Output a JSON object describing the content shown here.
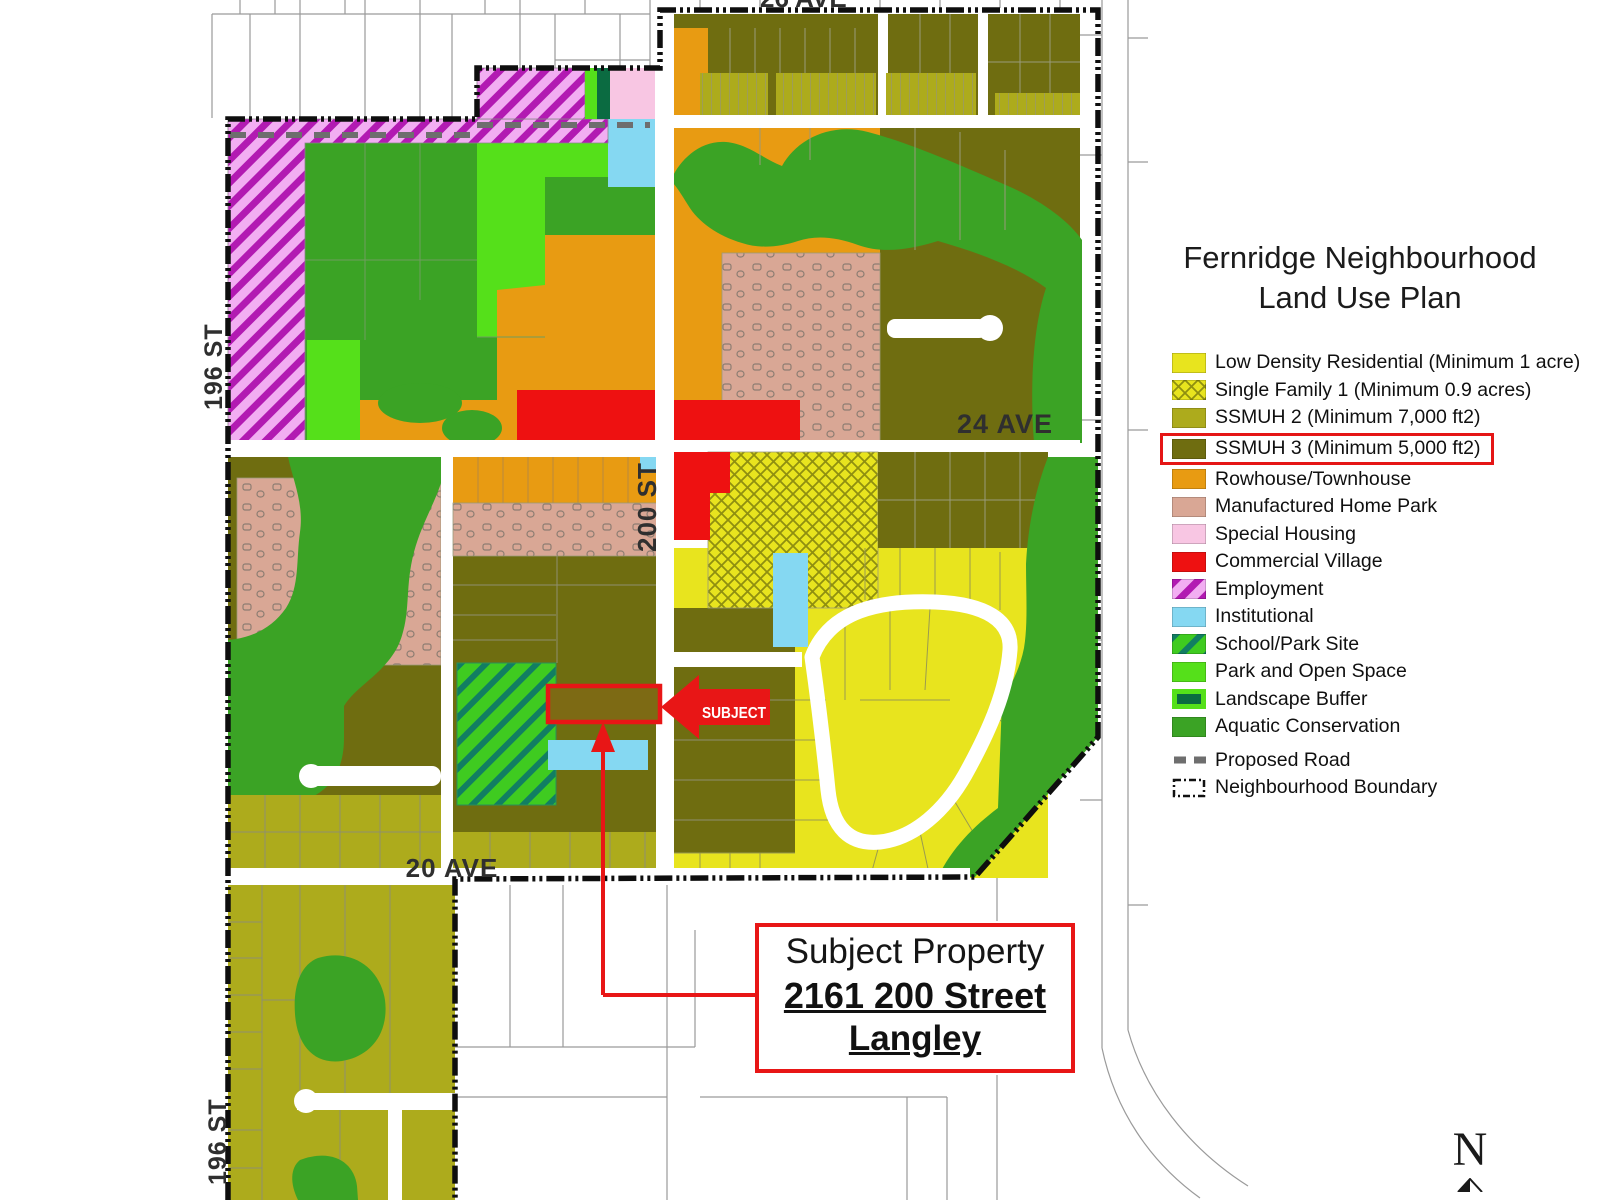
{
  "title": {
    "line1": "Fernridge Neighbourhood",
    "line2": "Land Use Plan"
  },
  "map": {
    "street_labels": {
      "ave26_clipped": "26 AVE",
      "ave24": "24 AVE",
      "ave20": "20 AVE",
      "st200": "200 ST",
      "st196_upper": "196 ST",
      "st196_lower": "196 ST"
    },
    "subject_label": "SUBJECT"
  },
  "callout": {
    "line1": "Subject Property",
    "line2": "2161 200 Street",
    "line3": "Langley"
  },
  "compass": {
    "label": "N"
  },
  "legend": {
    "items": [
      {
        "label": "Low Density Residential (Minimum 1 acre)",
        "color": "#e8e41e",
        "swatch": "solid"
      },
      {
        "label": "Single Family 1 (Minimum 0.9 acres)",
        "color": "#e8e41e",
        "stripe": "#8f8f10",
        "swatch": "crosshatch"
      },
      {
        "label": "SSMUH 2 (Minimum 7,000 ft2)",
        "color": "#adab1c",
        "swatch": "solid"
      },
      {
        "label": "SSMUH 3 (Minimum 5,000 ft2)",
        "color": "#6f6d10",
        "swatch": "solid",
        "highlighted": true
      },
      {
        "label": "Rowhouse/Townhouse",
        "color": "#e89b12",
        "swatch": "solid"
      },
      {
        "label": "Manufactured Home Park",
        "color": "#d9a795",
        "swatch": "solid"
      },
      {
        "label": "Special Housing",
        "color": "#f8c6e3",
        "swatch": "solid"
      },
      {
        "label": "Commercial Village",
        "color": "#ee1111",
        "swatch": "solid"
      },
      {
        "label": "Employment",
        "color": "#f2aef2",
        "stripe": "#b21ab2",
        "swatch": "stripes"
      },
      {
        "label": "Institutional",
        "color": "#85d8f2",
        "swatch": "solid"
      },
      {
        "label": "School/Park Site",
        "color": "#3fcb20",
        "stripe": "#117e62",
        "swatch": "stripes"
      },
      {
        "label": "Park and Open Space",
        "color": "#55e01a",
        "swatch": "solid"
      },
      {
        "label": "Landscape Buffer",
        "color": "#0b6b41",
        "border": "#55e01a",
        "swatch": "bordered"
      },
      {
        "label": "Aquatic Conservation",
        "color": "#3ba325",
        "swatch": "solid"
      },
      {
        "label": "Proposed Road",
        "color": "#6e6e6e",
        "swatch": "dashed-line"
      },
      {
        "label": "Neighbourhood Boundary",
        "color": "#111111",
        "swatch": "dashdot-box"
      }
    ]
  },
  "colors": {
    "ldr": "#e8e41e",
    "ssmuh2": "#adab1c",
    "ssmuh3": "#6f6d10",
    "rowhouse": "#e89b12",
    "mhp": "#d9a795",
    "special": "#f8c6e3",
    "commercial": "#ee1111",
    "employment_bg": "#f2aef2",
    "employment_stripe": "#b21ab2",
    "institutional": "#85d8f2",
    "school_bg": "#3fcb20",
    "school_stripe": "#117e62",
    "park": "#55e01a",
    "buffer": "#0b6b41",
    "aquatic": "#3ba325",
    "subject_parcel_fill": "#7d6a14",
    "callout_red": "#e81616",
    "highlight_red": "#e51616",
    "boundary": "#0e0e0e",
    "proposed_road": "#6e6e6e"
  }
}
